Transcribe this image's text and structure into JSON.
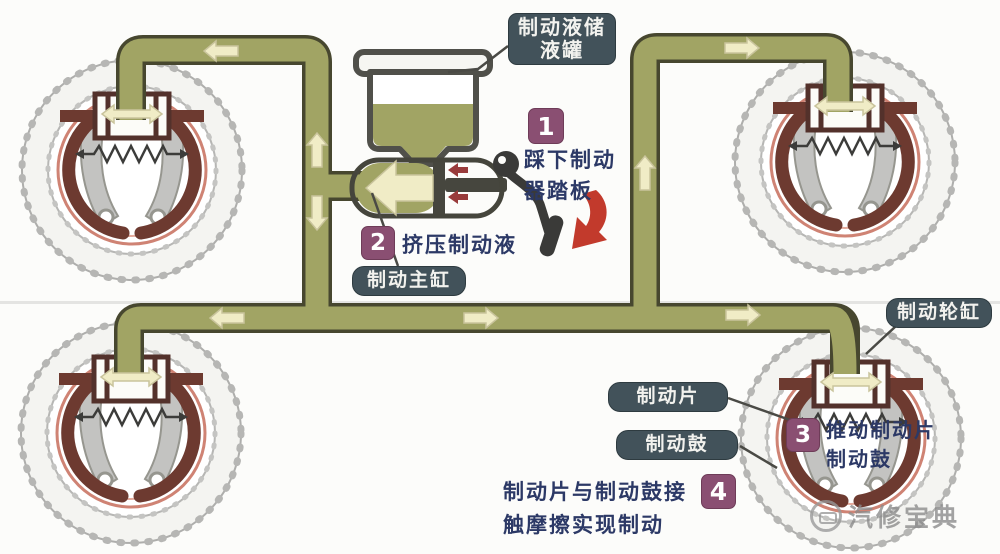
{
  "title": "汽车液压鼓式制动系统工作原理图",
  "labels": {
    "fluid_reservoir": {
      "full": "制动液储液罐",
      "lines": [
        "制动液储",
        "液罐"
      ]
    },
    "master_cylinder": "制动主缸",
    "wheel_cylinder": "制动轮缸",
    "brake_pad": "制动片",
    "brake_drum": "制动鼓"
  },
  "steps": [
    {
      "num": "1",
      "full": "踩下制动器踏板",
      "lines": [
        "踩下制动",
        "器踏板"
      ]
    },
    {
      "num": "2",
      "full": "挤压制动液",
      "lines": [
        "挤压制动液",
        ""
      ]
    },
    {
      "num": "3",
      "full": "推动制动片制动鼓",
      "lines": [
        "推动制动片",
        "制动鼓"
      ]
    },
    {
      "num": "4",
      "full": "制动片与制动鼓接触摩擦实现制动",
      "lines": [
        "制动片与制动鼓接",
        "触摩擦实现制动"
      ]
    }
  ],
  "watermark": {
    "text": "汽修宝典"
  },
  "colors": {
    "pipe_fill": "#a1a464",
    "pipe_outline": "#47472f",
    "label_box": "#42525a",
    "badge": "#8a4f72",
    "step_text": "#2c3966",
    "brake_shoe": "#6d3a30",
    "wheel_cylinder_frame": "#53312b",
    "drum_ring": "#cf8374",
    "flow_arrow": "#f0ecc6",
    "press_arrow_red": "#c23a2c",
    "piston_arrow_red": "#993b3b",
    "pedal_black": "#3a3a38"
  },
  "icons": {
    "flow_arrows": [
      {
        "name": "flow-arrow-front-left",
        "direction": "left"
      },
      {
        "name": "flow-arrow-riser-up",
        "direction": "up"
      },
      {
        "name": "flow-arrow-riser-down",
        "direction": "down"
      },
      {
        "name": "flow-arrow-trunk-left",
        "direction": "left"
      },
      {
        "name": "flow-arrow-trunk-right-1",
        "direction": "right"
      },
      {
        "name": "flow-arrow-trunk-right-2",
        "direction": "right"
      },
      {
        "name": "flow-arrow-rear-riser-up",
        "direction": "up"
      },
      {
        "name": "flow-arrow-front-right",
        "direction": "right"
      }
    ],
    "wheel_cylinder_arrow": "double-horizontal-outward",
    "spring_arrows": "outward-pair",
    "piston_arrows": "two-left",
    "pedal_press_arrow": "curved-down-left"
  }
}
